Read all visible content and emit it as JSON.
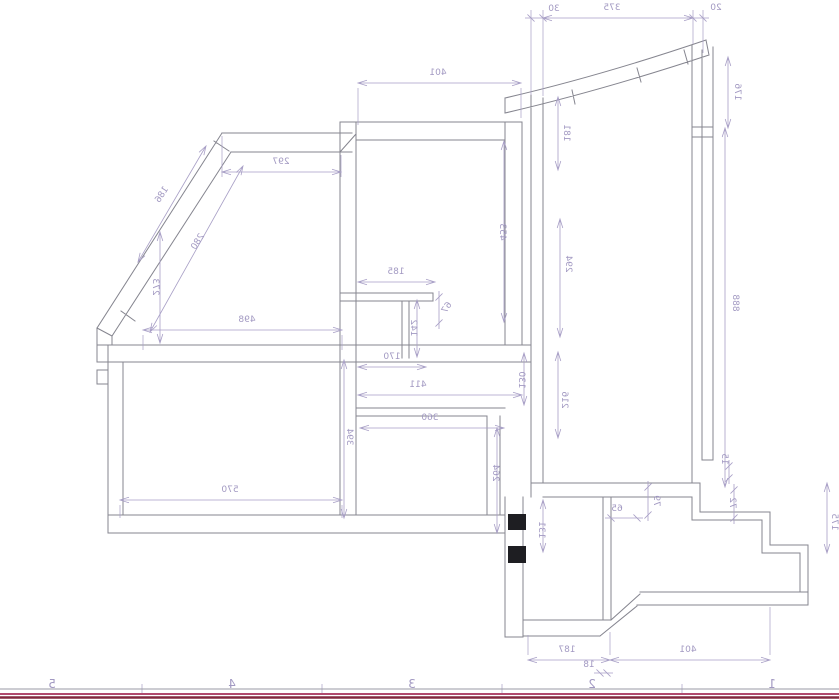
{
  "drawing": {
    "kind": "cad-floor-plan-mirrored",
    "mirrored": true,
    "colors": {
      "wall_line": "#85858f",
      "dim_line": "#a89fc6",
      "dim_text": "#a299c2",
      "section_fill": "#1e1e22",
      "sheet_line_gray": "#9a9aa4",
      "sheet_border_inner": "#b14a6e",
      "sheet_border_outer": "#82293f"
    },
    "dimensions": [
      {
        "value": "30",
        "x1": 531,
        "y1": 18,
        "x2": 543,
        "y2": 18,
        "lx": 554,
        "ly": 11,
        "rot": 0
      },
      {
        "value": "375",
        "x1": 543,
        "y1": 18,
        "x2": 693,
        "y2": 18,
        "lx": 612,
        "ly": 10,
        "rot": 0
      },
      {
        "value": "20",
        "x1": 693,
        "y1": 18,
        "x2": 703,
        "y2": 18,
        "lx": 716,
        "ly": 10,
        "rot": 0
      },
      {
        "value": "176",
        "x1": 728,
        "y1": 57,
        "x2": 728,
        "y2": 128,
        "lx": 735,
        "ly": 92,
        "rot": 90
      },
      {
        "value": "181",
        "x1": 558,
        "y1": 97,
        "x2": 558,
        "y2": 170,
        "lx": 564,
        "ly": 133,
        "rot": 90
      },
      {
        "value": "401",
        "x1": 358,
        "y1": 83,
        "x2": 521,
        "y2": 83,
        "lx": 438,
        "ly": 75,
        "rot": 0
      },
      {
        "value": "297",
        "x1": 222,
        "y1": 172,
        "x2": 341,
        "y2": 172,
        "lx": 281,
        "ly": 164,
        "rot": 0
      },
      {
        "value": "186",
        "x1": 138,
        "y1": 262,
        "x2": 206,
        "y2": 146,
        "lx": 164,
        "ly": 196,
        "rot": -57
      },
      {
        "value": "280",
        "x1": 150,
        "y1": 332,
        "x2": 243,
        "y2": 166,
        "lx": 200,
        "ly": 243,
        "rot": -57
      },
      {
        "value": "273",
        "x1": 160,
        "y1": 232,
        "x2": 160,
        "y2": 343,
        "lx": 153,
        "ly": 287,
        "rot": 90
      },
      {
        "value": "498",
        "x1": 143,
        "y1": 330,
        "x2": 342,
        "y2": 330,
        "lx": 247,
        "ly": 322,
        "rot": 0
      },
      {
        "value": "185",
        "x1": 358,
        "y1": 282,
        "x2": 435,
        "y2": 282,
        "lx": 396,
        "ly": 274,
        "rot": 0
      },
      {
        "value": "67",
        "x1": 439,
        "y1": 297,
        "x2": 439,
        "y2": 323,
        "lx": 449,
        "ly": 309,
        "rot": -57
      },
      {
        "value": "142",
        "x1": 417,
        "y1": 300,
        "x2": 417,
        "y2": 357,
        "lx": 411,
        "ly": 328,
        "rot": 90
      },
      {
        "value": "170",
        "x1": 358,
        "y1": 367,
        "x2": 426,
        "y2": 367,
        "lx": 392,
        "ly": 359,
        "rot": 0
      },
      {
        "value": "411",
        "x1": 358,
        "y1": 395,
        "x2": 522,
        "y2": 395,
        "lx": 418,
        "ly": 387,
        "rot": 0
      },
      {
        "value": "360",
        "x1": 360,
        "y1": 428,
        "x2": 504,
        "y2": 428,
        "lx": 430,
        "ly": 420,
        "rot": 0
      },
      {
        "value": "130",
        "x1": 524,
        "y1": 353,
        "x2": 524,
        "y2": 405,
        "lx": 519,
        "ly": 380,
        "rot": 90
      },
      {
        "value": "453",
        "x1": 504,
        "y1": 141,
        "x2": 504,
        "y2": 322,
        "lx": 500,
        "ly": 232,
        "rot": 90
      },
      {
        "value": "294",
        "x1": 560,
        "y1": 219,
        "x2": 560,
        "y2": 337,
        "lx": 566,
        "ly": 264,
        "rot": 90
      },
      {
        "value": "216",
        "x1": 558,
        "y1": 352,
        "x2": 558,
        "y2": 438,
        "lx": 562,
        "ly": 400,
        "rot": 90
      },
      {
        "value": "888",
        "x1": 725,
        "y1": 128,
        "x2": 725,
        "y2": 487,
        "lx": 733,
        "ly": 303,
        "rot": 90
      },
      {
        "value": "394",
        "x1": 344,
        "y1": 360,
        "x2": 344,
        "y2": 518,
        "lx": 347,
        "ly": 437,
        "rot": 90
      },
      {
        "value": "570",
        "x1": 120,
        "y1": 500,
        "x2": 342,
        "y2": 500,
        "lx": 230,
        "ly": 492,
        "rot": 0
      },
      {
        "value": "264",
        "x1": 497,
        "y1": 428,
        "x2": 497,
        "y2": 533,
        "lx": 493,
        "ly": 473,
        "rot": 90
      },
      {
        "value": "131",
        "x1": 543,
        "y1": 500,
        "x2": 543,
        "y2": 552,
        "lx": 539,
        "ly": 530,
        "rot": 90
      },
      {
        "value": "15",
        "x1": 729,
        "y1": 466,
        "x2": 729,
        "y2": 478,
        "lx": 722,
        "ly": 459,
        "rot": 90
      },
      {
        "value": "72",
        "x1": 734,
        "y1": 490,
        "x2": 734,
        "y2": 518,
        "lx": 730,
        "ly": 503,
        "rot": 90
      },
      {
        "value": "79",
        "x1": 648,
        "y1": 487,
        "x2": 648,
        "y2": 515,
        "lx": 654,
        "ly": 501,
        "rot": 90
      },
      {
        "value": "65",
        "x1": 611,
        "y1": 518,
        "x2": 637,
        "y2": 518,
        "lx": 617,
        "ly": 511,
        "rot": 0
      },
      {
        "value": "175",
        "x1": 827,
        "y1": 483,
        "x2": 827,
        "y2": 553,
        "lx": 832,
        "ly": 522,
        "rot": 90
      },
      {
        "value": "187",
        "x1": 528,
        "y1": 660,
        "x2": 610,
        "y2": 660,
        "lx": 567,
        "ly": 652,
        "rot": 0
      },
      {
        "value": "18",
        "x1": 600,
        "y1": 673,
        "x2": 607,
        "y2": 673,
        "lx": 589,
        "ly": 667,
        "rot": 0
      },
      {
        "value": "401",
        "x1": 610,
        "y1": 660,
        "x2": 770,
        "y2": 660,
        "lx": 688,
        "ly": 652,
        "rot": 0
      }
    ],
    "sheet_grid": {
      "y": 688,
      "labels": [
        {
          "text": "5",
          "x": 52
        },
        {
          "text": "4",
          "x": 232
        },
        {
          "text": "3",
          "x": 412
        },
        {
          "text": "2",
          "x": 592
        },
        {
          "text": "1",
          "x": 772
        }
      ],
      "tick_xs": [
        142,
        322,
        502,
        682
      ]
    }
  }
}
